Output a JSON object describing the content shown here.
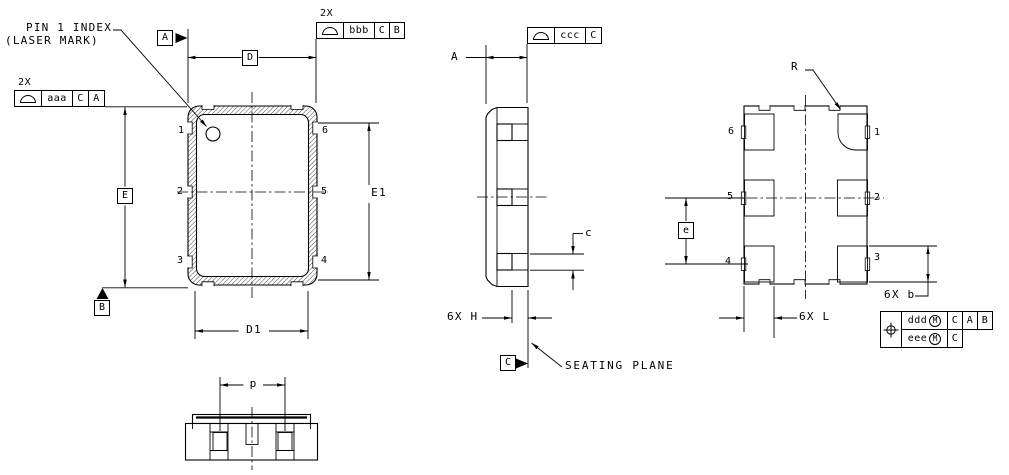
{
  "labels": {
    "pin1_index": "PIN 1 INDEX",
    "laser_mark": "(LASER MARK)",
    "seating_plane": "SEATING PLANE",
    "radius": "R",
    "dim_d": "D",
    "dim_d1": "D1",
    "dim_e_body": "E",
    "dim_e1": "E1",
    "dim_e_pitch": "e",
    "dim_p": "p",
    "dim_a": "A",
    "dim_c": "c",
    "dim_h": "6X H",
    "dim_l": "6X L",
    "dim_b": "6X b",
    "qty_aaa": "2X",
    "qty_bbb": "2X"
  },
  "datum_flags": {
    "a": "A",
    "b": "B",
    "c": "C"
  },
  "fcf": {
    "aaa": {
      "tol": "aaa",
      "ref1": "C",
      "ref2": "A"
    },
    "bbb": {
      "tol": "bbb",
      "ref1": "C",
      "ref2": "B"
    },
    "ccc": {
      "tol": "ccc",
      "ref1": "C"
    },
    "position": {
      "row1": {
        "tol": "ddd",
        "mod": "M",
        "ref1": "C",
        "ref2": "A",
        "ref3": "B"
      },
      "row2": {
        "tol": "eee",
        "mod": "M",
        "ref1": "C"
      }
    }
  },
  "front_view": {
    "pins": {
      "1": "1",
      "2": "2",
      "3": "3",
      "4": "4",
      "5": "5",
      "6": "6"
    }
  },
  "bottom_view": {
    "pins": {
      "1": "1",
      "2": "2",
      "3": "3",
      "4": "4",
      "5": "5",
      "6": "6"
    }
  },
  "colors": {
    "line": "#000000",
    "background": "#ffffff"
  }
}
